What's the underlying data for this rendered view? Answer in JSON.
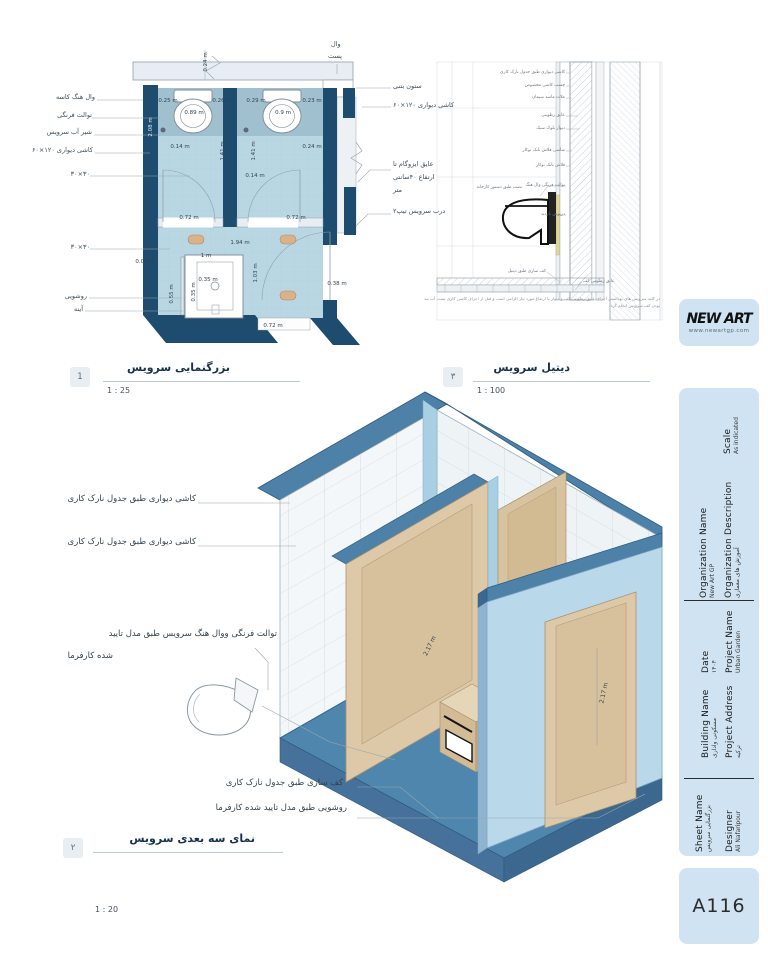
{
  "views": {
    "plan": {
      "number": "1",
      "title": "بزرگنمایی سرویس",
      "scale": "1 : 25",
      "left_labels": [
        {
          "t": "وال هنگ کاسه",
          "r": 673,
          "y": 94
        },
        {
          "t": "توالت فرنگی",
          "r": 676,
          "y": 112
        },
        {
          "t": "شیر آب سرویس",
          "r": 676,
          "y": 129
        },
        {
          "t": "کاشی دیواری ۱۲۰×۶۰",
          "r": 675,
          "y": 147
        },
        {
          "t": "۳۰×۳۰",
          "r": 678,
          "y": 171
        },
        {
          "t": "۳۰×۳۰",
          "r": 678,
          "y": 244
        },
        {
          "t": "روشویی",
          "r": 681,
          "y": 293
        },
        {
          "t": "آینه",
          "r": 685,
          "y": 306
        }
      ],
      "right_labels": [
        {
          "t": "ستون بتنی",
          "l": 393,
          "y": 83
        },
        {
          "t": "کاشی دیواری ۱۲۰×۶۰",
          "l": 393,
          "y": 102
        },
        {
          "t": "عایق ایزوگام تا",
          "l": 393,
          "y": 161
        },
        {
          "t": "ارتفاع ۴۰سانتی",
          "l": 393,
          "y": 174
        },
        {
          "t": "متر",
          "l": 393,
          "y": 187
        },
        {
          "t": "درب سرویس تیپ۲",
          "l": 393,
          "y": 208
        }
      ],
      "top_labels": [
        {
          "t": "وال",
          "l": 331,
          "y": 41
        },
        {
          "t": "پست",
          "l": 328,
          "y": 53
        }
      ],
      "dims": [
        {
          "t": "0.25 m",
          "x": 168,
          "y": 101
        },
        {
          "t": "0.26 m",
          "x": 222,
          "y": 101
        },
        {
          "t": "0.89 m",
          "x": 194,
          "y": 113
        },
        {
          "t": "0.29 m",
          "x": 256,
          "y": 101
        },
        {
          "t": "0.23 m",
          "x": 312,
          "y": 101
        },
        {
          "t": "0.9 m",
          "x": 283,
          "y": 113
        },
        {
          "t": "0.14 m",
          "x": 180,
          "y": 147
        },
        {
          "t": "1.41 m",
          "x": 223,
          "y": 151,
          "rot": -90
        },
        {
          "t": "1.41 m",
          "x": 254,
          "y": 151,
          "rot": -90
        },
        {
          "t": "0.24 m",
          "x": 312,
          "y": 147
        },
        {
          "t": "0.14 m",
          "x": 255,
          "y": 176
        },
        {
          "t": "0.72 m",
          "x": 189,
          "y": 218
        },
        {
          "t": "0.72 m",
          "x": 296,
          "y": 218
        },
        {
          "t": "1.94 m",
          "x": 240,
          "y": 243
        },
        {
          "t": "1 m",
          "x": 206,
          "y": 256
        },
        {
          "t": "0.35 m",
          "x": 208,
          "y": 280
        },
        {
          "t": "0.55 m",
          "x": 172,
          "y": 294,
          "rot": -90
        },
        {
          "t": "0.35 m",
          "x": 194,
          "y": 292,
          "rot": -90
        },
        {
          "t": "1.03 m",
          "x": 256,
          "y": 273,
          "rot": -90
        },
        {
          "t": "0.08 m",
          "x": 145,
          "y": 262
        },
        {
          "t": "0.38 m",
          "x": 337,
          "y": 284
        },
        {
          "t": "0.72 m",
          "x": 273,
          "y": 326
        },
        {
          "t": "0.24 m",
          "x": 206,
          "y": 62,
          "rot": -90
        },
        {
          "t": "2.08 m",
          "x": 151,
          "y": 127,
          "rot": -90,
          "c": "#dcebf3"
        }
      ]
    },
    "detail": {
      "number": "۳",
      "title": "دیتیل سرویس",
      "scale": "1 : 100",
      "labels": [
        {
          "t": "کاشی دیواری طبق جدول نازک کاری",
          "r": 203,
          "y": 71
        },
        {
          "t": "چسب کاشی مخصوص",
          "r": 203,
          "y": 84
        },
        {
          "t": "ملات ماسه سیمان",
          "r": 203,
          "y": 96
        },
        {
          "t": "عایق رطوبتی",
          "r": 203,
          "y": 114
        },
        {
          "t": "دیوار بلوک سبک",
          "r": 203,
          "y": 127
        },
        {
          "t": "شاسی فلاش تانک توکار",
          "r": 203,
          "y": 149
        },
        {
          "t": "فلاش تانک توکار",
          "r": 203,
          "y": 164
        },
        {
          "t": "توالت فرنگی وال هنگ",
          "r": 203,
          "y": 184
        },
        {
          "t": "درپوش بازدید",
          "r": 203,
          "y": 213
        },
        {
          "t": "نصب طبق دستور کارخانه",
          "r": 246,
          "y": 186
        },
        {
          "t": "کف سازی طبق دیتیل",
          "r": 222,
          "y": 270
        },
        {
          "t": "عایق رطوبتی کف",
          "l": 583,
          "y": 280
        }
      ],
      "notes": [
        {
          "t": "در کلیه سرویس های بهداشتی اجرای عایق رطوبتی کف و دیوار تا ارتفاع مورد نیاز الزامی است و قبل از اجرای کاشی کاری تست آب بند",
          "r": 108,
          "y": 297
        },
        {
          "t": "بودن کف سرویس انجام گردد",
          "r": 108,
          "y": 304
        }
      ]
    },
    "iso": {
      "number": "۲",
      "title": "نمای سه بعدی سرویس",
      "scale": "1 : 20",
      "labels": [
        {
          "t": "کاشی دیواری طبق جدول نارک کاری",
          "r": 572,
          "y": 495
        },
        {
          "t": "کاشی دیواری طبق جدول نارک کاری",
          "r": 572,
          "y": 538
        },
        {
          "t": "توالت فرنگی ووال هنگ سرویس طبق مدل تایید",
          "r": 491,
          "y": 630
        },
        {
          "t": "شده کارفرما",
          "r": 655,
          "y": 652
        },
        {
          "t": "کف سازی طبق جدول نازک کاری",
          "r": 425,
          "y": 779
        },
        {
          "t": "روشویی طبق مدل تایید شده کارفرما",
          "r": 421,
          "y": 804
        }
      ],
      "dims": [
        {
          "t": "2.17 m",
          "x": 604,
          "y": 693,
          "rot": -78
        },
        {
          "t": "2.17 m",
          "x": 430,
          "y": 646,
          "rot": -64
        }
      ]
    }
  },
  "titleblock": {
    "logo": {
      "name": "NEW ART",
      "url": "www.newartgp.com"
    },
    "fields": [
      {
        "label": "Scale",
        "value": "As indicated"
      },
      {
        "label": "Organization Name",
        "value": "New Art GP"
      },
      {
        "label": "Organization Description",
        "value": "آموزش های معماری"
      },
      {
        "label": "Date",
        "value": "۱۴۰۴"
      },
      {
        "label": "Project Name",
        "value": "Urban Garden"
      },
      {
        "label": "Building Name",
        "value": "مسکونی واداری"
      },
      {
        "label": "Project Address",
        "value": "ترکیه"
      },
      {
        "label": "Sheet Name",
        "value": "بزرگنمایی سرویس"
      },
      {
        "label": "Designer",
        "value": "Ali Nafaripour"
      }
    ],
    "sheet_number": "A116"
  }
}
